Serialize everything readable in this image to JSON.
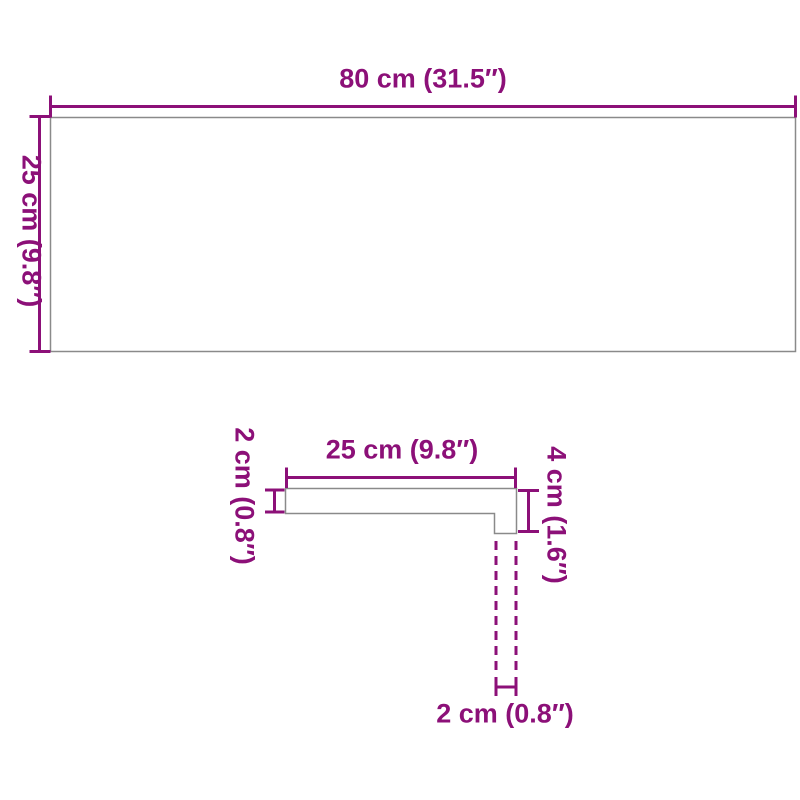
{
  "colors": {
    "dimension_purple": "#8C1078",
    "outline_gray": "#8A8A8A",
    "background": "#FFFFFF"
  },
  "top_view": {
    "description": "panel top view rectangle",
    "width_label": "80 cm (31.5″)",
    "height_label": "25 cm (9.8″)"
  },
  "profile_view": {
    "description": "panel edge L-profile cross-section",
    "top_width_label": "25 cm (9.8″)",
    "thickness_label": "2 cm (0.8″)",
    "edge_height_label": "4 cm (1.6″)",
    "lip_width_label": "2 cm (0.8″)"
  }
}
